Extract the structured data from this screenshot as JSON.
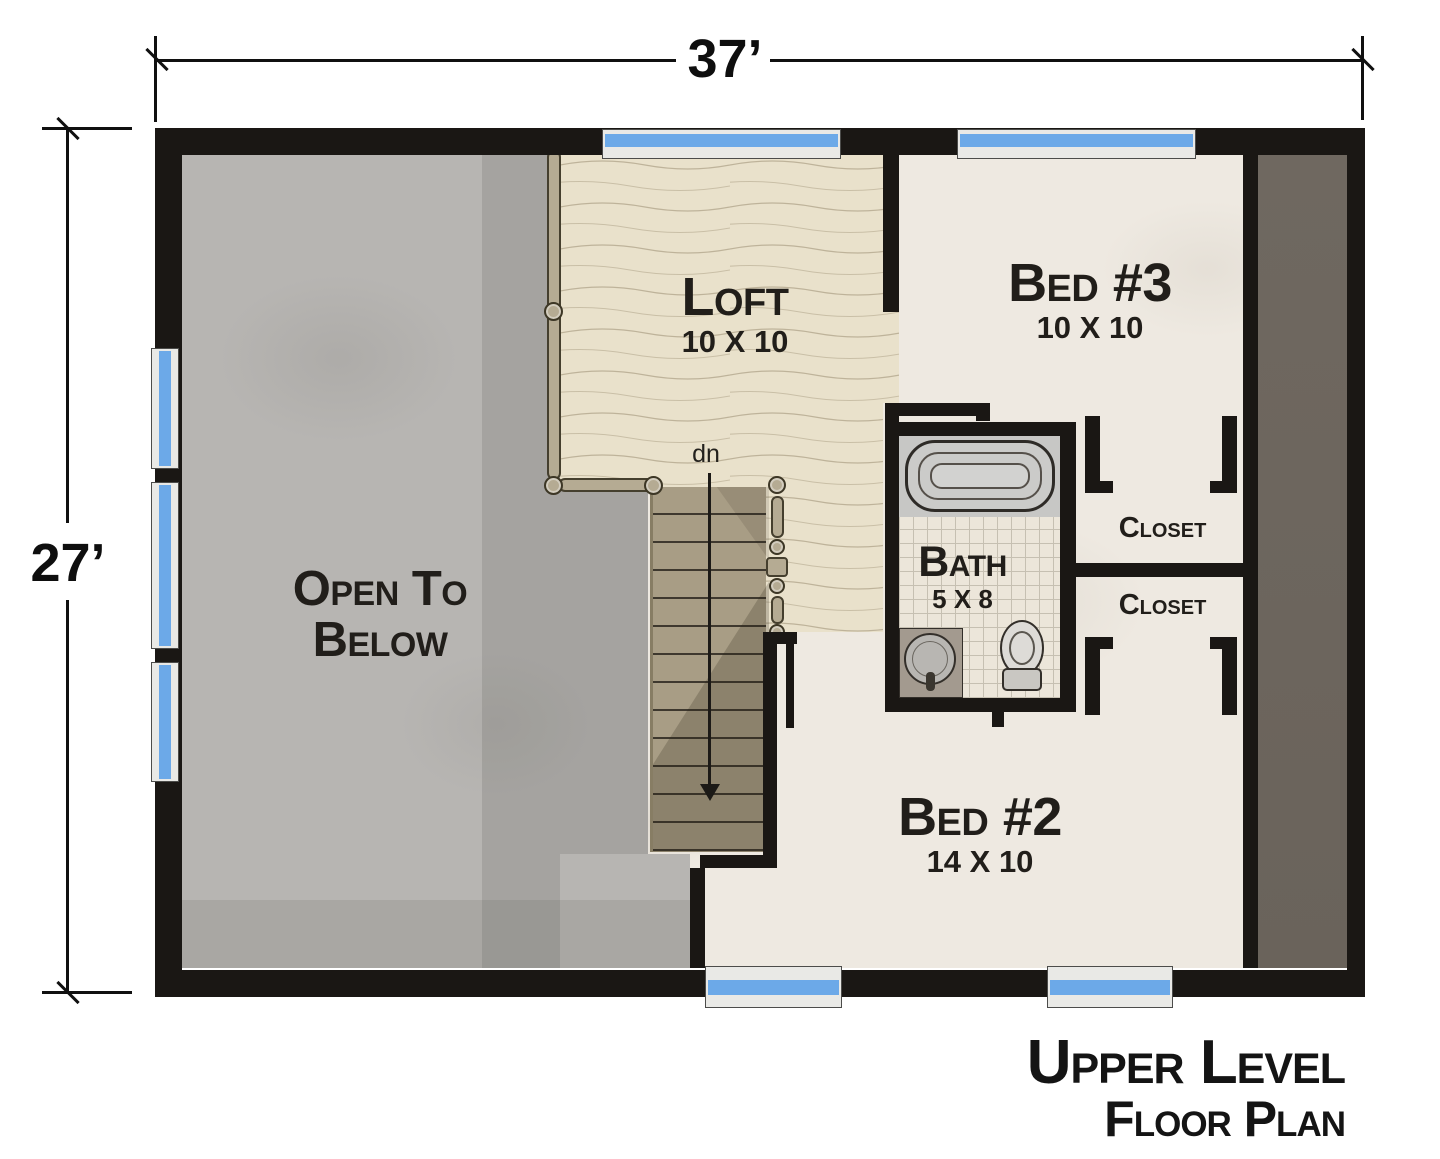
{
  "plan": {
    "width_dimension": "37’",
    "height_dimension": "27’",
    "stairs_label": "dn",
    "title_line1": "Upper Level",
    "title_line2": "Floor Plan"
  },
  "rooms": {
    "open_below": {
      "line1": "Open To",
      "line2": "Below"
    },
    "loft": {
      "name": "Loft",
      "size": "10 X 10"
    },
    "bed3": {
      "name": "Bed #3",
      "size": "10 X 10"
    },
    "bath": {
      "name": "Bath",
      "size": "5 X 8"
    },
    "closet_upper": {
      "name": "Closet"
    },
    "closet_lower": {
      "name": "Closet"
    },
    "bed2": {
      "name": "Bed #2",
      "size": "14 X 10"
    }
  },
  "colors": {
    "wall": "#1a1714",
    "window_blue": "#6ca9e8",
    "wood_floor": "#e9e1cb",
    "open_below_gray": "#b7b5b2",
    "attic_taupe": "#6e675f",
    "stair_tan": "#a89d85",
    "rail_tan": "#b5ab93"
  }
}
